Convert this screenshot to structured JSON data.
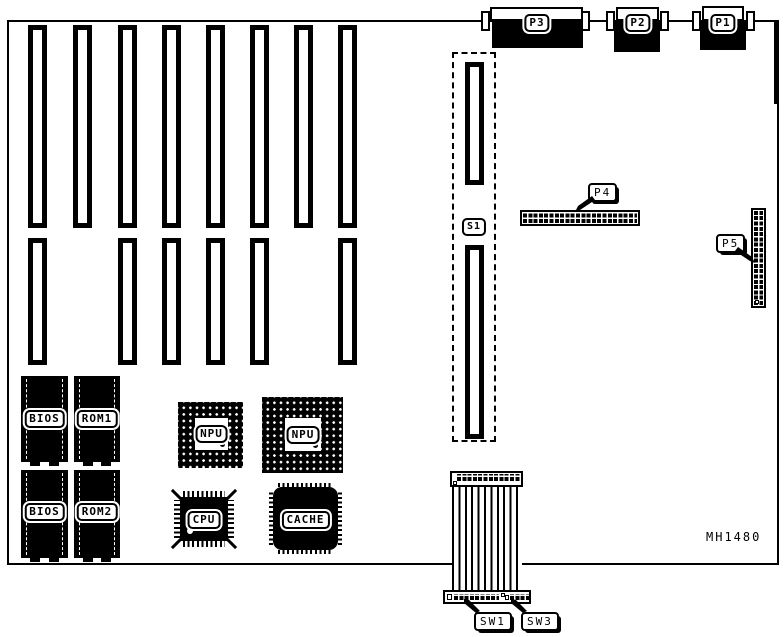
{
  "board": {
    "part_number": "MH1480"
  },
  "colors": {
    "ink": "#000000",
    "paper": "#ffffff"
  },
  "rear_ports": {
    "p1": "P1",
    "p2": "P2",
    "p3": "P3"
  },
  "connectors": {
    "p4": "P4",
    "p5": "P5",
    "s1": "S1"
  },
  "switches": {
    "sw1": "SW1",
    "sw3": "SW3"
  },
  "chips": {
    "bios1": "BIOS",
    "rom1": "ROM1",
    "bios2": "BIOS",
    "rom2": "ROM2",
    "npu1": "NPU",
    "npu2": "NPU",
    "cpu": "CPU",
    "cache": "CACHE"
  }
}
